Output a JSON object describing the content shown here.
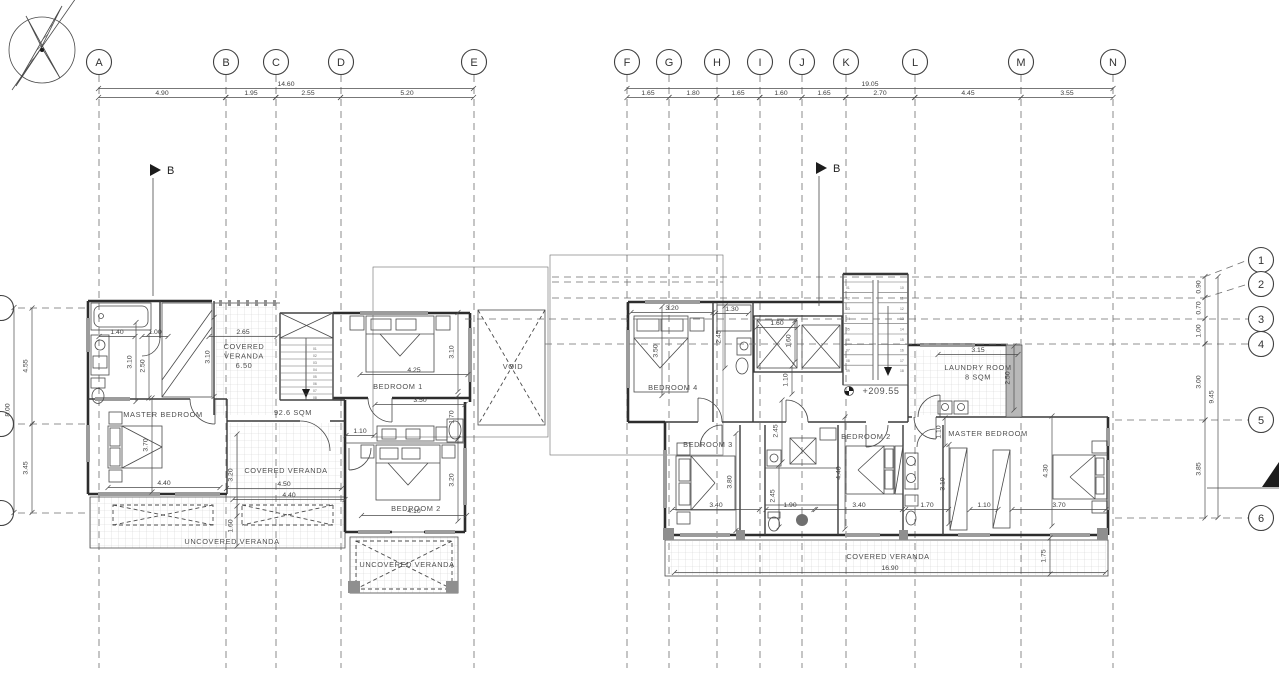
{
  "meta": {
    "drawing_type": "architectural-floor-plan",
    "level_note": "+209.55"
  },
  "grid": {
    "columns": [
      {
        "label": "A",
        "x": 99
      },
      {
        "label": "B",
        "x": 226
      },
      {
        "label": "C",
        "x": 276
      },
      {
        "label": "D",
        "x": 341
      },
      {
        "label": "E",
        "x": 474
      },
      {
        "label": "F",
        "x": 627
      },
      {
        "label": "G",
        "x": 669
      },
      {
        "label": "H",
        "x": 717
      },
      {
        "label": "I",
        "x": 760
      },
      {
        "label": "J",
        "x": 802
      },
      {
        "label": "K",
        "x": 846
      },
      {
        "label": "L",
        "x": 915
      },
      {
        "label": "M",
        "x": 1021
      },
      {
        "label": "N",
        "x": 1113
      }
    ],
    "rows_right": [
      {
        "label": "1",
        "cy": 260,
        "ly": 277,
        "x1": 552
      },
      {
        "label": "2",
        "cy": 284,
        "ly": 298,
        "x1": 552
      },
      {
        "label": "3",
        "cy": 319,
        "ly": 319,
        "x1": 465
      },
      {
        "label": "4",
        "cy": 344,
        "ly": 344,
        "x1": 545
      },
      {
        "label": "5",
        "cy": 420,
        "ly": 420,
        "x1": 1115
      },
      {
        "label": "6",
        "cy": 518,
        "ly": 518,
        "x1": 1115
      }
    ],
    "rows_left": [
      {
        "y": 308
      },
      {
        "y": 424
      },
      {
        "y": 513
      }
    ]
  },
  "section_markers": [
    {
      "label": "B",
      "x": 150,
      "y": 170,
      "drop": 118
    },
    {
      "label": "B",
      "x": 816,
      "y": 168,
      "drop": 130
    }
  ],
  "dimensions": [
    {
      "t": "14.60",
      "x": 286,
      "y": 86,
      "l": 375
    },
    {
      "t": "4.90",
      "x": 162,
      "y": 95,
      "l": 127
    },
    {
      "t": "1.95",
      "x": 251,
      "y": 95,
      "l": 50
    },
    {
      "t": "2.55",
      "x": 308,
      "y": 95,
      "l": 65
    },
    {
      "t": "5.20",
      "x": 407,
      "y": 95,
      "l": 133
    },
    {
      "t": "19.05",
      "x": 870,
      "y": 86,
      "l": 486
    },
    {
      "t": "1.65",
      "x": 648,
      "y": 95,
      "l": 42
    },
    {
      "t": "1.80",
      "x": 693,
      "y": 95,
      "l": 48
    },
    {
      "t": "1.65",
      "x": 738,
      "y": 95,
      "l": 43
    },
    {
      "t": "1.60",
      "x": 781,
      "y": 95,
      "l": 42
    },
    {
      "t": "1.65",
      "x": 824,
      "y": 95,
      "l": 44
    },
    {
      "t": "2.70",
      "x": 880,
      "y": 95,
      "l": 69
    },
    {
      "t": "4.45",
      "x": 968,
      "y": 95,
      "l": 106
    },
    {
      "t": "3.55",
      "x": 1067,
      "y": 95,
      "l": 92
    },
    {
      "t": "0.90",
      "x": 1202,
      "y": 287,
      "v": 1,
      "l": 21
    },
    {
      "t": "0.70",
      "x": 1202,
      "y": 308,
      "v": 1,
      "l": 21
    },
    {
      "t": "1.00",
      "x": 1202,
      "y": 331,
      "v": 1,
      "l": 25
    },
    {
      "t": "3.00",
      "x": 1202,
      "y": 382,
      "v": 1,
      "l": 76
    },
    {
      "t": "3.85",
      "x": 1202,
      "y": 469,
      "v": 1,
      "l": 98
    },
    {
      "t": "9.45",
      "x": 1215,
      "y": 397,
      "v": 1,
      "l": 241
    },
    {
      "t": "4.55",
      "x": 29,
      "y": 366,
      "v": 1,
      "l": 116
    },
    {
      "t": "8.00",
      "x": 11,
      "y": 410,
      "v": 1,
      "l": 205
    },
    {
      "t": "3.45",
      "x": 29,
      "y": 468,
      "v": 1,
      "l": 89
    },
    {
      "t": "1.40",
      "x": 117,
      "y": 334,
      "l": 36
    },
    {
      "t": "1.00",
      "x": 155,
      "y": 334,
      "l": 26
    },
    {
      "t": "3.10",
      "x": 133,
      "y": 362,
      "v": 1,
      "l": 79
    },
    {
      "t": "2.50",
      "x": 146,
      "y": 366,
      "v": 1,
      "l": 64
    },
    {
      "t": "2.65",
      "x": 243,
      "y": 334,
      "l": 68
    },
    {
      "t": "3.10",
      "x": 211,
      "y": 357,
      "v": 1,
      "l": 79
    },
    {
      "t": "4.25",
      "x": 414,
      "y": 372,
      "l": 108
    },
    {
      "t": "3.10",
      "x": 455,
      "y": 352,
      "v": 1,
      "l": 79
    },
    {
      "t": "3.50",
      "x": 420,
      "y": 402,
      "l": 90
    },
    {
      "t": "1.70",
      "x": 455,
      "y": 417,
      "v": 1,
      "l": 43
    },
    {
      "t": "1.10",
      "x": 360,
      "y": 433,
      "l": 28
    },
    {
      "t": "3.70",
      "x": 149,
      "y": 445,
      "v": 1,
      "l": 94
    },
    {
      "t": "4.40",
      "x": 164,
      "y": 485,
      "l": 112
    },
    {
      "t": "3.20",
      "x": 234,
      "y": 475,
      "v": 1,
      "l": 82
    },
    {
      "t": "4.50",
      "x": 284,
      "y": 486,
      "l": 115
    },
    {
      "t": "4.40",
      "x": 289,
      "y": 497,
      "l": 112
    },
    {
      "t": "3.20",
      "x": 455,
      "y": 480,
      "v": 1,
      "l": 82
    },
    {
      "t": "4.10",
      "x": 414,
      "y": 513,
      "l": 105
    },
    {
      "t": "1.60",
      "x": 234,
      "y": 526,
      "v": 1,
      "l": 40
    },
    {
      "t": "3.20",
      "x": 672,
      "y": 310,
      "l": 82
    },
    {
      "t": "1.30",
      "x": 732,
      "y": 311,
      "l": 33
    },
    {
      "t": "3.50",
      "x": 659,
      "y": 351,
      "v": 1,
      "l": 89
    },
    {
      "t": "2.45",
      "x": 722,
      "y": 337,
      "v": 1,
      "l": 62
    },
    {
      "t": "1.60",
      "x": 777,
      "y": 325,
      "l": 41
    },
    {
      "t": "1.60",
      "x": 792,
      "y": 341,
      "v": 1,
      "l": 41
    },
    {
      "t": "1.10",
      "x": 789,
      "y": 380,
      "v": 1,
      "l": 28
    },
    {
      "t": "2.45",
      "x": 779,
      "y": 431,
      "v": 1,
      "l": 62
    },
    {
      "t": "3.15",
      "x": 978,
      "y": 352,
      "l": 80
    },
    {
      "t": "2.50",
      "x": 1011,
      "y": 378,
      "v": 1,
      "l": 64
    },
    {
      "t": "3.80",
      "x": 733,
      "y": 482,
      "v": 1,
      "l": 97
    },
    {
      "t": "3.40",
      "x": 716,
      "y": 507,
      "l": 87
    },
    {
      "t": "2.45",
      "x": 776,
      "y": 496,
      "v": 1,
      "l": 62
    },
    {
      "t": "1.90",
      "x": 790,
      "y": 507,
      "l": 48
    },
    {
      "t": "4.40",
      "x": 842,
      "y": 473,
      "v": 1,
      "l": 112
    },
    {
      "t": "3.40",
      "x": 859,
      "y": 507,
      "l": 87
    },
    {
      "t": "1.10",
      "x": 942,
      "y": 432,
      "v": 1,
      "l": 28
    },
    {
      "t": "3.10",
      "x": 946,
      "y": 484,
      "v": 1,
      "l": 79
    },
    {
      "t": "1.70",
      "x": 927,
      "y": 507,
      "l": 43
    },
    {
      "t": "1.10",
      "x": 984,
      "y": 507,
      "l": 28
    },
    {
      "t": "3.70",
      "x": 1059,
      "y": 507,
      "l": 94
    },
    {
      "t": "4.30",
      "x": 1049,
      "y": 471,
      "v": 1,
      "l": 110
    },
    {
      "t": "1.75",
      "x": 1047,
      "y": 556,
      "v": 1,
      "l": 36
    },
    {
      "t": "16.90",
      "x": 890,
      "y": 570,
      "l": 431
    }
  ],
  "room_labels": [
    {
      "t": "MASTER BEDROOM",
      "x": 163,
      "y": 417
    },
    {
      "t": "92.6 SQM",
      "x": 293,
      "y": 415
    },
    {
      "lines": [
        "COVERED",
        "VERANDA",
        "6.50"
      ],
      "x": 244,
      "y": 349
    },
    {
      "t": "BEDROOM 1",
      "x": 398,
      "y": 389
    },
    {
      "t": "VOID",
      "x": 513,
      "y": 369
    },
    {
      "t": "COVERED VERANDA",
      "x": 286,
      "y": 473
    },
    {
      "t": "BEDROOM 2",
      "x": 416,
      "y": 511
    },
    {
      "t": "UNCOVERED VERANDA",
      "x": 232,
      "y": 544
    },
    {
      "t": "UNCOVERED VERANDA",
      "x": 407,
      "y": 567
    },
    {
      "t": "BEDROOM 4",
      "x": 673,
      "y": 390
    },
    {
      "t": "BEDROOM 3",
      "x": 708,
      "y": 447
    },
    {
      "t": "BEDROOM 2",
      "x": 866,
      "y": 439
    },
    {
      "t": "MASTER BEDROOM",
      "x": 988,
      "y": 436
    },
    {
      "lines": [
        "LAUNDRY ROOM",
        "8 SQM"
      ],
      "x": 978,
      "y": 370
    },
    {
      "t": "+209.55",
      "x": 881,
      "y": 394,
      "fs": 9
    },
    {
      "t": "COVERED VERANDA",
      "x": 888,
      "y": 559
    }
  ],
  "stairs": {
    "left": [
      "01",
      "02",
      "03",
      "04",
      "05",
      "06",
      "07",
      "08"
    ],
    "right_a": [
      "01",
      "02",
      "03",
      "04",
      "05",
      "06",
      "07",
      "08",
      "09"
    ],
    "right_b": [
      "10",
      "11",
      "12",
      "13",
      "14",
      "15",
      "16",
      "17",
      "18"
    ]
  }
}
